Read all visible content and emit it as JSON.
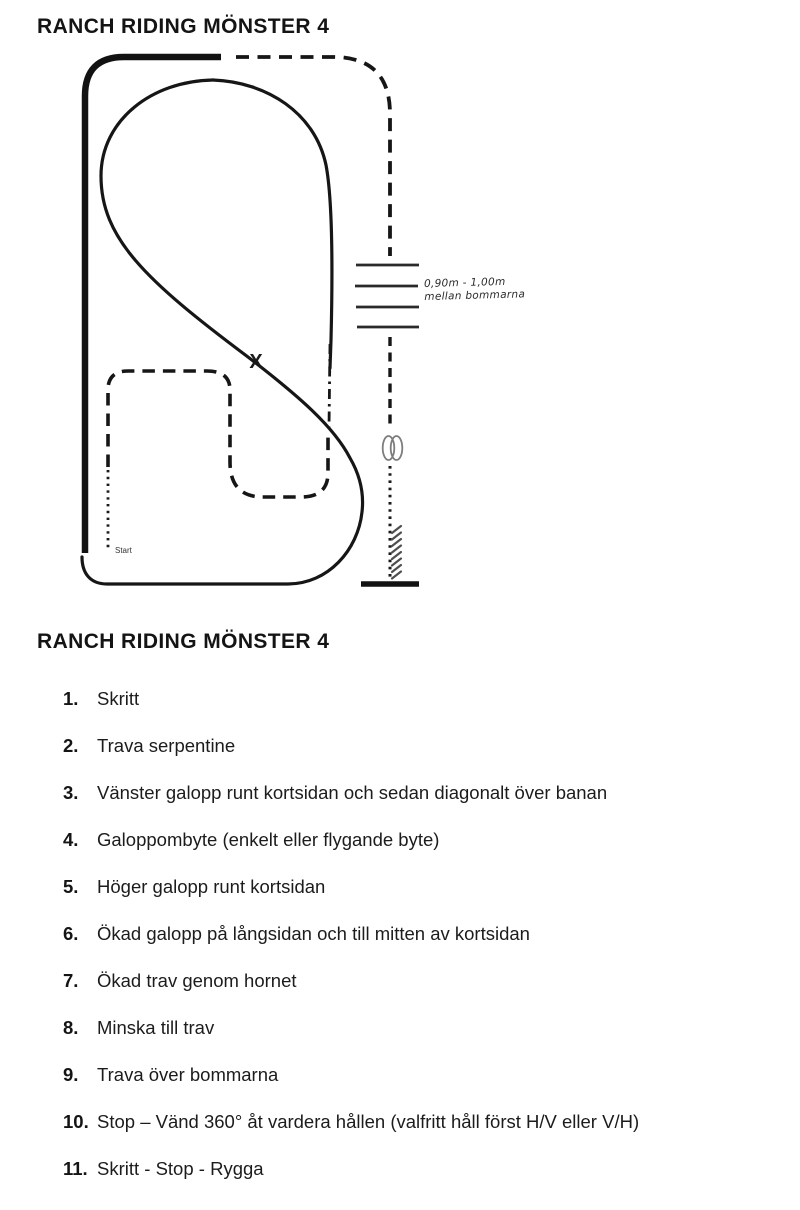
{
  "page": {
    "background": "#ffffff",
    "ink": "#1b1b1b"
  },
  "diagram": {
    "title": "RANCH RIDING MÖNSTER 4",
    "x_marker": "X",
    "start_label": "Start",
    "pole_note_line1": "0,90m - 1,00m",
    "pole_note_line2": "mellan bommarna",
    "spin_symbol_color": "#7d7d7d",
    "line_color": "#181818"
  },
  "pattern": {
    "heading": "RANCH RIDING MÖNSTER 4",
    "items": [
      {
        "num": "1.",
        "text": "Skritt"
      },
      {
        "num": "2.",
        "text": "Trava serpentine"
      },
      {
        "num": "3.",
        "text": "Vänster galopp runt kortsidan och sedan diagonalt över banan"
      },
      {
        "num": "4.",
        "text": "Galoppombyte (enkelt eller flygande byte)"
      },
      {
        "num": "5.",
        "text": "Höger galopp runt kortsidan"
      },
      {
        "num": "6.",
        "text": "Ökad galopp på långsidan och till mitten av kortsidan"
      },
      {
        "num": "7.",
        "text": "Ökad trav genom hornet"
      },
      {
        "num": "8.",
        "text": "Minska till trav"
      },
      {
        "num": "9.",
        "text": "Trava över bommarna"
      },
      {
        "num": "10.",
        "text": "Stop – Vänd 360° åt vardera hållen (valfritt håll först H/V eller V/H)"
      },
      {
        "num": "11.",
        "text": "Skritt - Stop - Rygga"
      }
    ]
  }
}
